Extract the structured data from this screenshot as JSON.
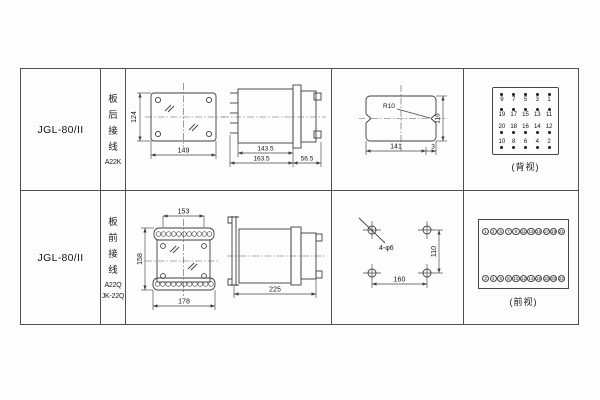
{
  "table": {
    "rows": [
      {
        "model": "JGL-80/II",
        "wiring": {
          "chars": [
            "板",
            "后",
            "接",
            "线"
          ],
          "code": "A22K"
        },
        "view": {
          "front": {
            "height": "124",
            "width": "149"
          },
          "side": {
            "body": "143.5",
            "total": "163.5",
            "front": "56.5"
          },
          "cutout": {
            "radius": "R10",
            "width": "141",
            "height": "116",
            "notch": "3"
          },
          "terminals": {
            "caption": "(背视)",
            "grid": [
              [
                "9",
                "7",
                "5",
                "3",
                "1"
              ],
              [
                "19",
                "17",
                "15",
                "13",
                "11"
              ],
              [
                "20",
                "18",
                "16",
                "14",
                "12"
              ],
              [
                "10",
                "8",
                "6",
                "4",
                "2"
              ]
            ]
          }
        }
      },
      {
        "model": "JGL-80/II",
        "wiring": {
          "chars": [
            "板",
            "前",
            "接",
            "线"
          ],
          "code": "A22Q",
          "code2": "JK-22Q"
        },
        "view": {
          "front": {
            "top_width": "153",
            "height": "158",
            "bottom_width": "178"
          },
          "side": {
            "total": "225"
          },
          "drill": {
            "label": "4-φ6",
            "width": "160",
            "height": "110"
          },
          "terminals": {
            "caption": "(前视)",
            "top_row": [
              "1",
              "3",
              "5",
              "7",
              "9",
              "11",
              "13",
              "15",
              "17",
              "19",
              "21"
            ],
            "bottom_row": [
              "2",
              "4",
              "6",
              "8",
              "10",
              "12",
              "14",
              "16",
              "18",
              "20",
              "22"
            ]
          }
        }
      }
    ]
  }
}
